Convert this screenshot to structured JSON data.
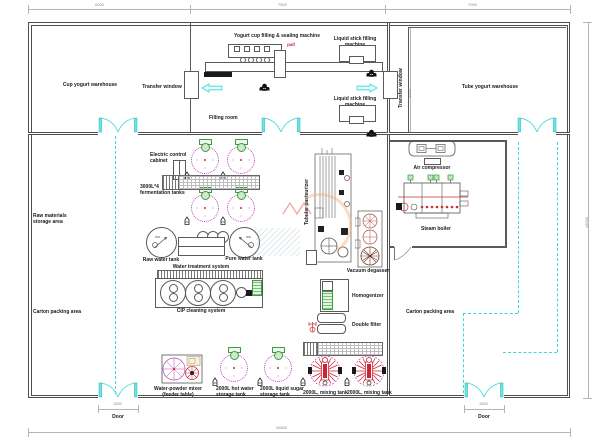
{
  "labels": {
    "cup_warehouse": "Cup yogurt warehouse",
    "transfer_window_left": "Transfer window",
    "transfer_window_right": "Transfer window",
    "yogurt_cup_machine": "Yogurt cup filling & sealing machine",
    "machine_red_note": "pall",
    "liquid_stick_machine_top": "Liquid stick filling machine",
    "liquid_stick_machine_bottom": "Liquid stick filling machine",
    "filling_room": "Filling room",
    "tube_warehouse": "Tube yogurt warehouse",
    "raw_materials_area": "Raw materials\nstorage area",
    "electric_control_cabinet": "Electric control\ncabinet",
    "fermentation_tanks": "3000L*4\nfermentation tanks",
    "raw_water_tank": "Raw water tank",
    "pure_water_tank": "Pure water tank",
    "water_treatment_system": "Water treatment system",
    "cip_cleaning_system": "CIP cleaning system",
    "carton_packing_left": "Carton packing area",
    "carton_packing_right": "Carton packing area",
    "tubular_pasteurizer": "Tubular pasteurizer",
    "vacuum_degasser": "Vacuum degasser",
    "homogenizer": "Homogenizer",
    "double_filter": "Double filter",
    "air_compressor": "Air compressor",
    "steam_boiler": "Steam boiler",
    "water_powder_mixer": "Water-powder mixer\n(feeder table)",
    "hot_water_tank": "2000L hot water\nstorage tank",
    "liquid_sugar_tank": "2000L liquid sugar\nstorage tank",
    "mixing_tank_1": "2000L, mixing tank",
    "mixing_tank_2": "2000L, mixing tank",
    "door_bottom_left": "Door",
    "door_bottom_right": "Door"
  },
  "dimensions": {
    "top_left": "6000",
    "top_middle": "7500",
    "top_right": "7000",
    "right_height": "15000",
    "transfer_bay_height": "4000",
    "door_left_width": "1500",
    "door_right_width": "1500",
    "bottom_total": "26500"
  },
  "colors": {
    "wall": "#4f4f4f",
    "door_accent": "#35d8d8",
    "tank_outline": "#c43cc4",
    "motor_green": "#3a9e3a",
    "alert_red": "#cc3333",
    "dimension_gray": "#8a8a8a"
  }
}
